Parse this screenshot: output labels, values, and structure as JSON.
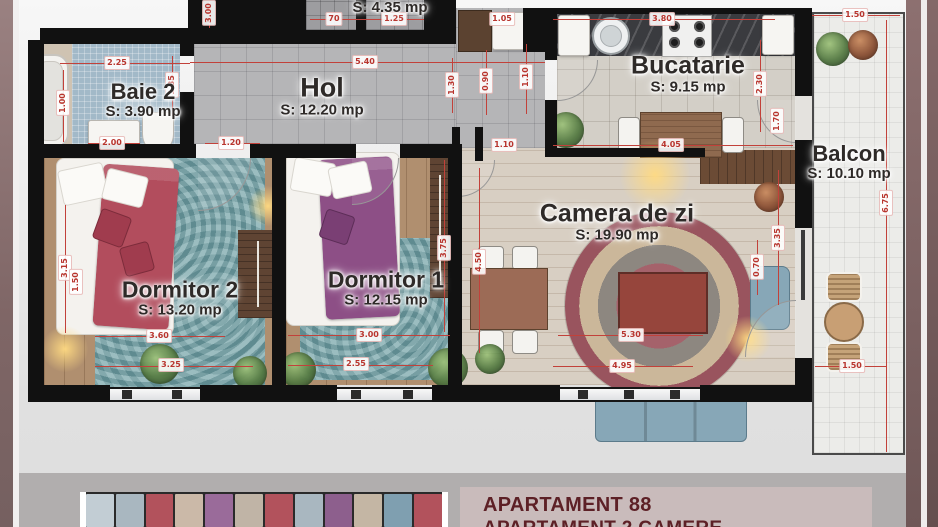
{
  "plan": {
    "rooms": [
      {
        "name": "Baie 2",
        "area": "S: 3.90 mp"
      },
      {
        "name": "Hol",
        "area": "S: 12.20 mp"
      },
      {
        "name": "",
        "area": "S: 4.35 mp"
      },
      {
        "name": "Bucatarie",
        "area": "S: 9.15 mp"
      },
      {
        "name": "Balcon",
        "area": "S: 10.10 mp"
      },
      {
        "name": "Camera de zi",
        "area": "S: 19.90 mp"
      },
      {
        "name": "Dormitor 1",
        "area": "S: 12.15 mp"
      },
      {
        "name": "Dormitor 2",
        "area": "S: 13.20 mp"
      }
    ],
    "dimensions": [
      {
        "value": "2.25"
      },
      {
        "value": "3.00"
      },
      {
        "value": "1.00"
      },
      {
        "value": "1.35"
      },
      {
        "value": "2.00"
      },
      {
        "value": "1.20"
      },
      {
        "value": "70"
      },
      {
        "value": "1.25"
      },
      {
        "value": "5.40"
      },
      {
        "value": "1.30"
      },
      {
        "value": "1.05"
      },
      {
        "value": "0.90"
      },
      {
        "value": "1.10"
      },
      {
        "value": "1.10"
      },
      {
        "value": "3.80"
      },
      {
        "value": "2.30"
      },
      {
        "value": "1.70"
      },
      {
        "value": "4.05"
      },
      {
        "value": "1.50"
      },
      {
        "value": "6.75"
      },
      {
        "value": "3.35"
      },
      {
        "value": "0.70"
      },
      {
        "value": "1.50"
      },
      {
        "value": "3.15"
      },
      {
        "value": "1.50"
      },
      {
        "value": "3.60"
      },
      {
        "value": "3.25"
      },
      {
        "value": "3.00"
      },
      {
        "value": "2.55"
      },
      {
        "value": "3.75"
      },
      {
        "value": "4.50"
      },
      {
        "value": "5.30"
      },
      {
        "value": "4.95"
      }
    ]
  },
  "footer": {
    "title": "APARTAMENT 88",
    "subtitle": "APARTAMENT 2 CAMERE"
  },
  "colors": {
    "dimension_red": "#c2413a",
    "wall_black": "#111111",
    "footer_box_bg": "#c9bbbb",
    "footer_text": "#5d2026",
    "side_strip_mauve": "#8d7272"
  }
}
